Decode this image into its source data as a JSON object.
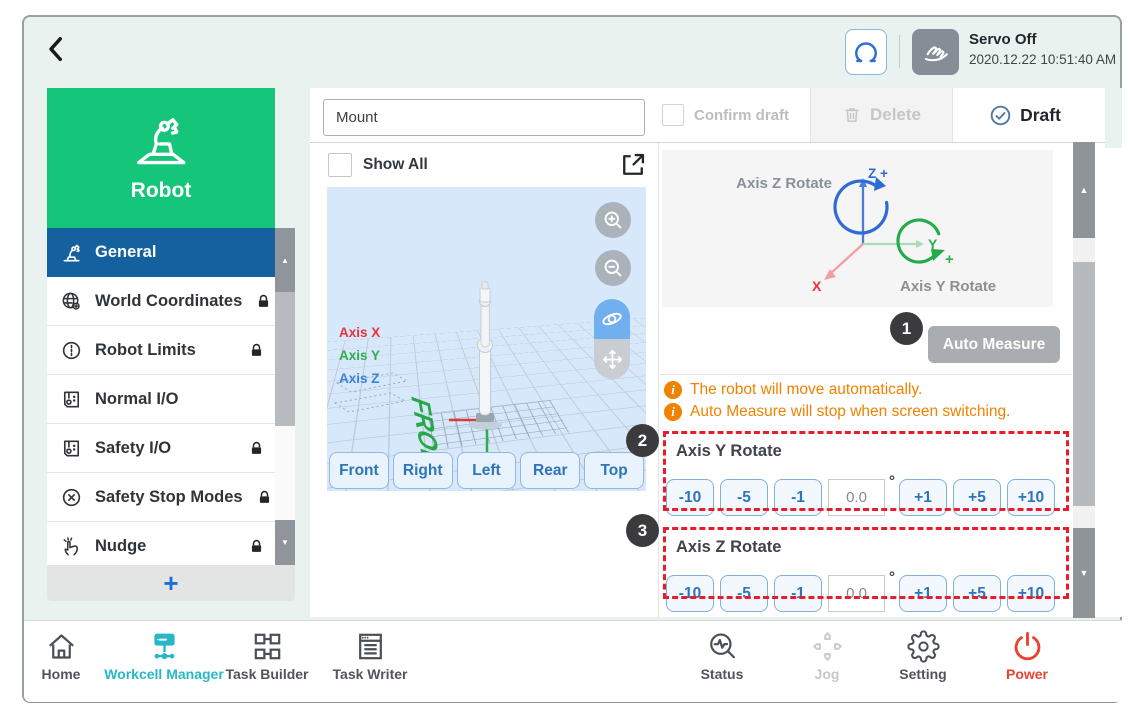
{
  "header": {
    "servo_status": "Servo Off",
    "datetime": "2020.12.22 10:51:40 AM"
  },
  "sidebar": {
    "title": "Robot",
    "items": [
      {
        "label": "General",
        "icon": "robot-arm-icon",
        "selected": true,
        "locked": false
      },
      {
        "label": "World Coordinates",
        "icon": "world-coordinates-icon",
        "selected": false,
        "locked": true
      },
      {
        "label": "Robot Limits",
        "icon": "robot-limits-icon",
        "selected": false,
        "locked": true
      },
      {
        "label": "Normal I/O",
        "icon": "io-icon",
        "selected": false,
        "locked": false
      },
      {
        "label": "Safety I/O",
        "icon": "io-icon",
        "selected": false,
        "locked": true
      },
      {
        "label": "Safety Stop Modes",
        "icon": "safety-stop-icon",
        "selected": false,
        "locked": true
      },
      {
        "label": "Nudge",
        "icon": "nudge-icon",
        "selected": false,
        "locked": true
      }
    ],
    "add_button_label": "+",
    "scroll_up_glyph": "▲",
    "scroll_down_glyph": "▼"
  },
  "toolbar": {
    "name_value": "Mount",
    "confirm_draft_label": "Confirm draft",
    "delete_label": "Delete",
    "draft_label": "Draft"
  },
  "viewer": {
    "show_all_label": "Show All",
    "axis_legend": [
      {
        "label": "Axis X",
        "color": "#e8333a"
      },
      {
        "label": "Axis Y",
        "color": "#2fae4d"
      },
      {
        "label": "Axis Z",
        "color": "#3b82d8"
      }
    ],
    "floor_marker": "FRONT",
    "view_buttons": [
      "Front",
      "Right",
      "Left",
      "Rear",
      "Top"
    ]
  },
  "measure_panel": {
    "diagram": {
      "axis_z_rotate_label": "Axis Z Rotate",
      "axis_y_rotate_label": "Axis Y Rotate",
      "z_label": "Z +",
      "y_label": "Y",
      "y_plus": "+",
      "x_label": "X"
    },
    "auto_measure_label": "Auto Measure",
    "callouts": [
      "1",
      "2",
      "3"
    ],
    "notes": [
      "The robot will move automatically.",
      "Auto Measure will stop when screen switching."
    ],
    "sections": [
      {
        "title": "Axis Y Rotate",
        "dec_buttons": [
          "-10",
          "-5",
          "-1"
        ],
        "value": "0.0",
        "unit": "°",
        "inc_buttons": [
          "+1",
          "+5",
          "+10"
        ]
      },
      {
        "title": "Axis Z Rotate",
        "dec_buttons": [
          "-10",
          "-5",
          "-1"
        ],
        "value": "0.0",
        "unit": "°",
        "inc_buttons": [
          "+1",
          "+5",
          "+10"
        ]
      }
    ]
  },
  "taskbar": {
    "items": [
      {
        "label": "Home",
        "icon": "home-icon",
        "state": "normal"
      },
      {
        "label": "Workcell Manager",
        "icon": "workcell-manager-icon",
        "state": "active"
      },
      {
        "label": "Task Builder",
        "icon": "task-builder-icon",
        "state": "normal"
      },
      {
        "label": "Task Writer",
        "icon": "task-writer-icon",
        "state": "normal"
      },
      {
        "label": "Status",
        "icon": "status-icon",
        "state": "normal"
      },
      {
        "label": "Jog",
        "icon": "jog-icon",
        "state": "disabled"
      },
      {
        "label": "Setting",
        "icon": "gear-icon",
        "state": "normal"
      },
      {
        "label": "Power",
        "icon": "power-icon",
        "state": "power"
      }
    ]
  },
  "colors": {
    "accent_green": "#14c57a",
    "selected_blue": "#15609f",
    "accent_teal": "#29b7c8",
    "alert_red": "#ea1c2c",
    "warning_orange": "#ef8200",
    "button_blue": "#2e74b8",
    "power_red": "#e8432f"
  }
}
